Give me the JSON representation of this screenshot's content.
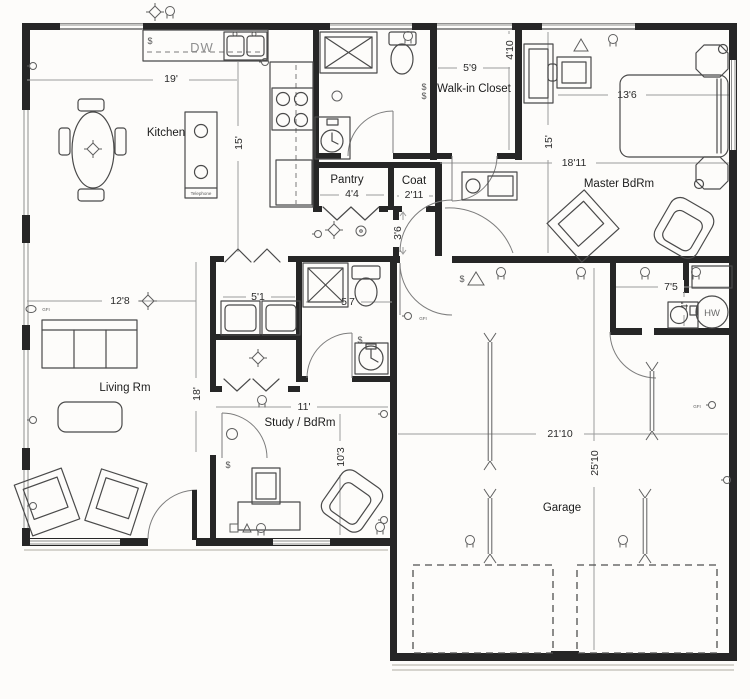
{
  "plan": {
    "rooms": {
      "kitchen": "Kitchen",
      "living": "Living Rm",
      "walkin": "Walk-in Closet",
      "master": "Master BdRm",
      "pantry": "Pantry",
      "coat": "Coat",
      "study": "Study / BdRm",
      "garage": "Garage"
    },
    "dims": {
      "w19": "19'",
      "h15k": "15'",
      "w59": "5'9",
      "h410": "4'10",
      "w136": "13'6",
      "h15m": "15'",
      "w1811": "18'11",
      "w44": "4'4",
      "w211": "2'11",
      "h36": "3'6",
      "w128": "12'8",
      "w51": "5'1",
      "w57": "5'7",
      "h18": "18'",
      "w11": "11'",
      "h103": "10'3",
      "w2110": "21'10",
      "h2510": "25'10",
      "w75": "7'5",
      "h4": "4'"
    },
    "labels": {
      "dw": "DW",
      "hw": "HW",
      "island": "Telephone",
      "gfi": "GFI",
      "sw": "$"
    }
  },
  "colors": {
    "wall": "#262626",
    "line": "#4a4a4a",
    "dimension": "#9c9c9c",
    "background": "#fdfcfa"
  }
}
